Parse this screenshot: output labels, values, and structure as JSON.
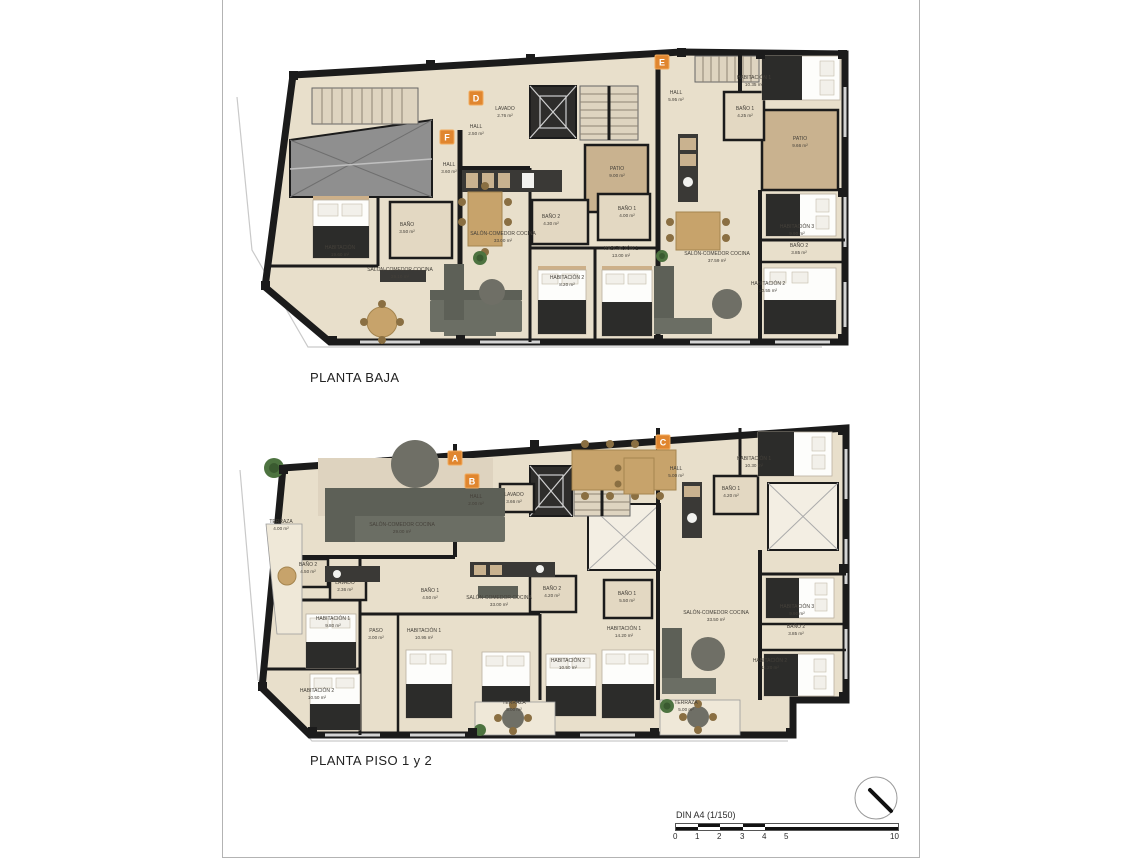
{
  "colors": {
    "accent_orange": "#e0862f",
    "wall_black": "#1b1b1b",
    "floor_beige": "#e8dfcb",
    "patio_tan": "#c9b28f",
    "page_border": "#b3b3b3"
  },
  "plans": [
    {
      "title": "PLANTA BAJA",
      "apartments": [
        {
          "letter": "D",
          "x": 476,
          "y": 98
        },
        {
          "letter": "E",
          "x": 662,
          "y": 62
        },
        {
          "letter": "F",
          "x": 447,
          "y": 137
        }
      ],
      "rooms": [
        {
          "label": "LAVADO",
          "area": "2.76 m²",
          "x": 505,
          "y": 112
        },
        {
          "label": "HALL",
          "area": "2.50 m²",
          "x": 476,
          "y": 130
        },
        {
          "label": "HALL",
          "area": "3.60 m²",
          "x": 449,
          "y": 168
        },
        {
          "label": "HALL",
          "area": "5.95 m²",
          "x": 676,
          "y": 96
        },
        {
          "label": "PATIO",
          "area": "9.00 m²",
          "x": 617,
          "y": 172
        },
        {
          "label": "PATIO",
          "area": "9.66 m²",
          "x": 800,
          "y": 142
        },
        {
          "label": "BAÑO",
          "area": "3.50 m²",
          "x": 407,
          "y": 228
        },
        {
          "label": "BAÑO 2",
          "area": "4.30 m²",
          "x": 551,
          "y": 220
        },
        {
          "label": "BAÑO 1",
          "area": "4.00 m²",
          "x": 627,
          "y": 212
        },
        {
          "label": "BAÑO 1",
          "area": "4.25 m²",
          "x": 745,
          "y": 112
        },
        {
          "label": "HABITACIÓN",
          "area": "19.60 m²",
          "x": 340,
          "y": 251
        },
        {
          "label": "SALÓN-COMEDOR COCINA",
          "area": "29.10 m²",
          "x": 400,
          "y": 273
        },
        {
          "label": "SALÓN-COMEDOR COCINA",
          "area": "33.00 m²",
          "x": 503,
          "y": 237
        },
        {
          "label": "SALÓN-COMEDOR COCINA",
          "area": "37.59 m²",
          "x": 717,
          "y": 257
        },
        {
          "label": "HABITACIÓN 1",
          "area": "13.00 m²",
          "x": 621,
          "y": 252
        },
        {
          "label": "HABITACIÓN 1",
          "area": "10.35 m²",
          "x": 754,
          "y": 81
        },
        {
          "label": "HABITACIÓN 2",
          "area": "8.20 m²",
          "x": 567,
          "y": 281
        },
        {
          "label": "HABITACIÓN 3",
          "area": "9.90 m²",
          "x": 797,
          "y": 230
        },
        {
          "label": "BAÑO 2",
          "area": "3.85 m²",
          "x": 799,
          "y": 249
        },
        {
          "label": "HABITACIÓN 2",
          "area": "10.55 m²",
          "x": 768,
          "y": 287
        }
      ]
    },
    {
      "title": "PLANTA PISO 1 y 2",
      "apartments": [
        {
          "letter": "A",
          "x": 455,
          "y": 458
        },
        {
          "letter": "B",
          "x": 472,
          "y": 481
        },
        {
          "letter": "C",
          "x": 663,
          "y": 442
        }
      ],
      "rooms": [
        {
          "label": "TERRAZA",
          "area": "4.00 m²",
          "x": 281,
          "y": 525
        },
        {
          "label": "SALÓN-COMEDOR COCINA",
          "area": "29.00 m²",
          "x": 402,
          "y": 528
        },
        {
          "label": "HALL",
          "area": "2.00 m²",
          "x": 476,
          "y": 500
        },
        {
          "label": "LAVADO",
          "area": "3.66 m²",
          "x": 514,
          "y": 498
        },
        {
          "label": "BAÑO 2",
          "area": "4.50 m²",
          "x": 308,
          "y": 568
        },
        {
          "label": "LAVADO",
          "area": "2.36 m²",
          "x": 345,
          "y": 586
        },
        {
          "label": "BAÑO 1",
          "area": "4.50 m²",
          "x": 430,
          "y": 594
        },
        {
          "label": "SALÓN-COMEDOR COCINA",
          "area": "33.00 m²",
          "x": 499,
          "y": 601
        },
        {
          "label": "BAÑO 2",
          "area": "4.20 m²",
          "x": 552,
          "y": 592
        },
        {
          "label": "BAÑO 1",
          "area": "5.50 m²",
          "x": 627,
          "y": 597
        },
        {
          "label": "HABITACIÓN 1",
          "area": "9.80 m²",
          "x": 333,
          "y": 622
        },
        {
          "label": "PASO",
          "area": "3.00 m²",
          "x": 376,
          "y": 634
        },
        {
          "label": "HABITACIÓN 1",
          "area": "10.95 m²",
          "x": 424,
          "y": 634
        },
        {
          "label": "HABITACIÓN 1",
          "area": "14.20 m²",
          "x": 624,
          "y": 632
        },
        {
          "label": "HABITACIÓN 2",
          "area": "10.50 m²",
          "x": 317,
          "y": 694
        },
        {
          "label": "HABITACIÓN 2",
          "area": "10.50 m²",
          "x": 568,
          "y": 664
        },
        {
          "label": "SALÓN-COMEDOR COCINA",
          "area": "33.50 m²",
          "x": 716,
          "y": 616
        },
        {
          "label": "TERRAZA",
          "area": "5.00 m²",
          "x": 514,
          "y": 706
        },
        {
          "label": "TERRAZA",
          "area": "5.00 m²",
          "x": 686,
          "y": 706
        },
        {
          "label": "HALL",
          "area": "5.00 m²",
          "x": 676,
          "y": 472
        },
        {
          "label": "HABITACIÓN 1",
          "area": "10.30 m²",
          "x": 754,
          "y": 462
        },
        {
          "label": "BAÑO 1",
          "area": "4.20 m²",
          "x": 731,
          "y": 492
        },
        {
          "label": "HABITACIÓN 3",
          "area": "9.90 m²",
          "x": 797,
          "y": 610
        },
        {
          "label": "BAÑO 2",
          "area": "3.85 m²",
          "x": 796,
          "y": 630
        },
        {
          "label": "HABITACIÓN 2",
          "area": "11.20 m²",
          "x": 770,
          "y": 664
        }
      ]
    }
  ],
  "scale_bar": {
    "label": "DIN A4 (1/150)",
    "ticks": [
      "0",
      "1",
      "2",
      "3",
      "4",
      "5",
      "10"
    ]
  }
}
